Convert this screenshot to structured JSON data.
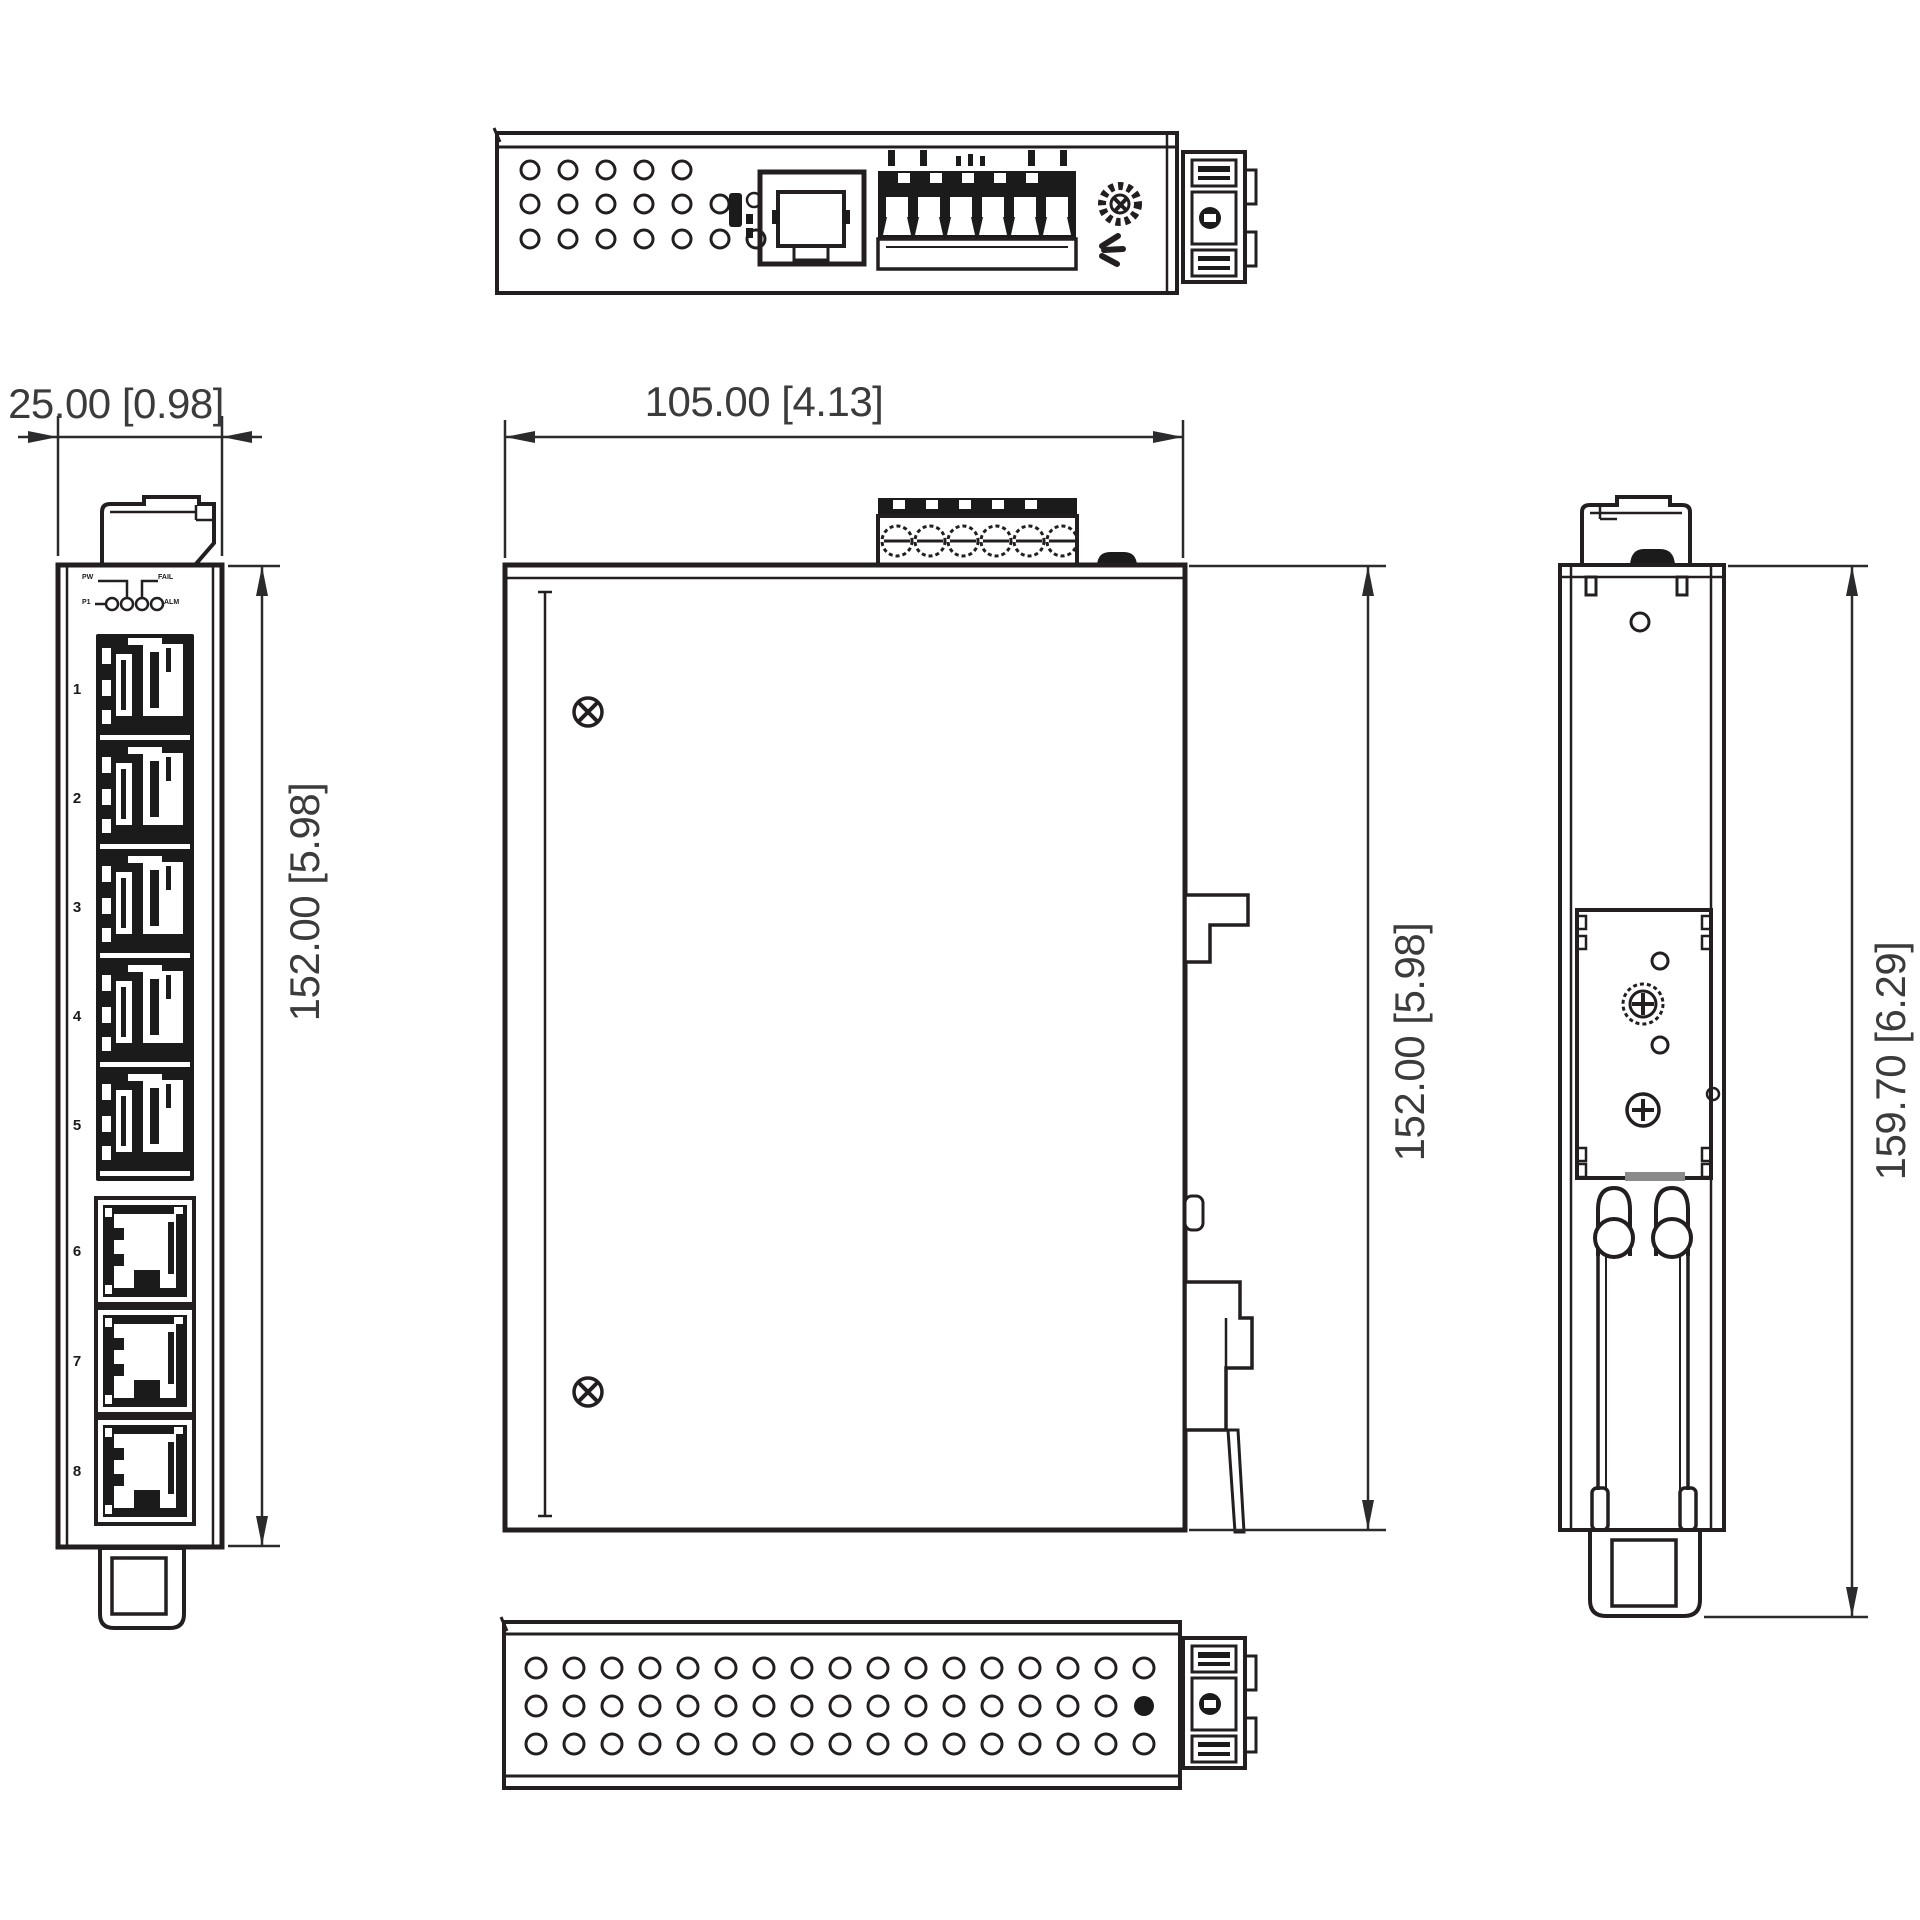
{
  "drawing": {
    "dimensions": {
      "front_width": "25.00 [0.98]",
      "side_width": "105.00 [4.13]",
      "front_height": "152.00 [5.98]",
      "side_height": "152.00 [5.98]",
      "overall_height": "159.70 [6.29]"
    },
    "front_panel": {
      "port_numbers": [
        "1",
        "2",
        "3",
        "4",
        "5",
        "6",
        "7",
        "8"
      ],
      "led_labels": {
        "top_left": "PW",
        "top_right": "FAIL",
        "bottom_left": "P1",
        "bottom_right": "ALM"
      }
    },
    "colors": {
      "line": "#231f20",
      "text": "#3b3b3d",
      "background": "#ffffff"
    }
  }
}
